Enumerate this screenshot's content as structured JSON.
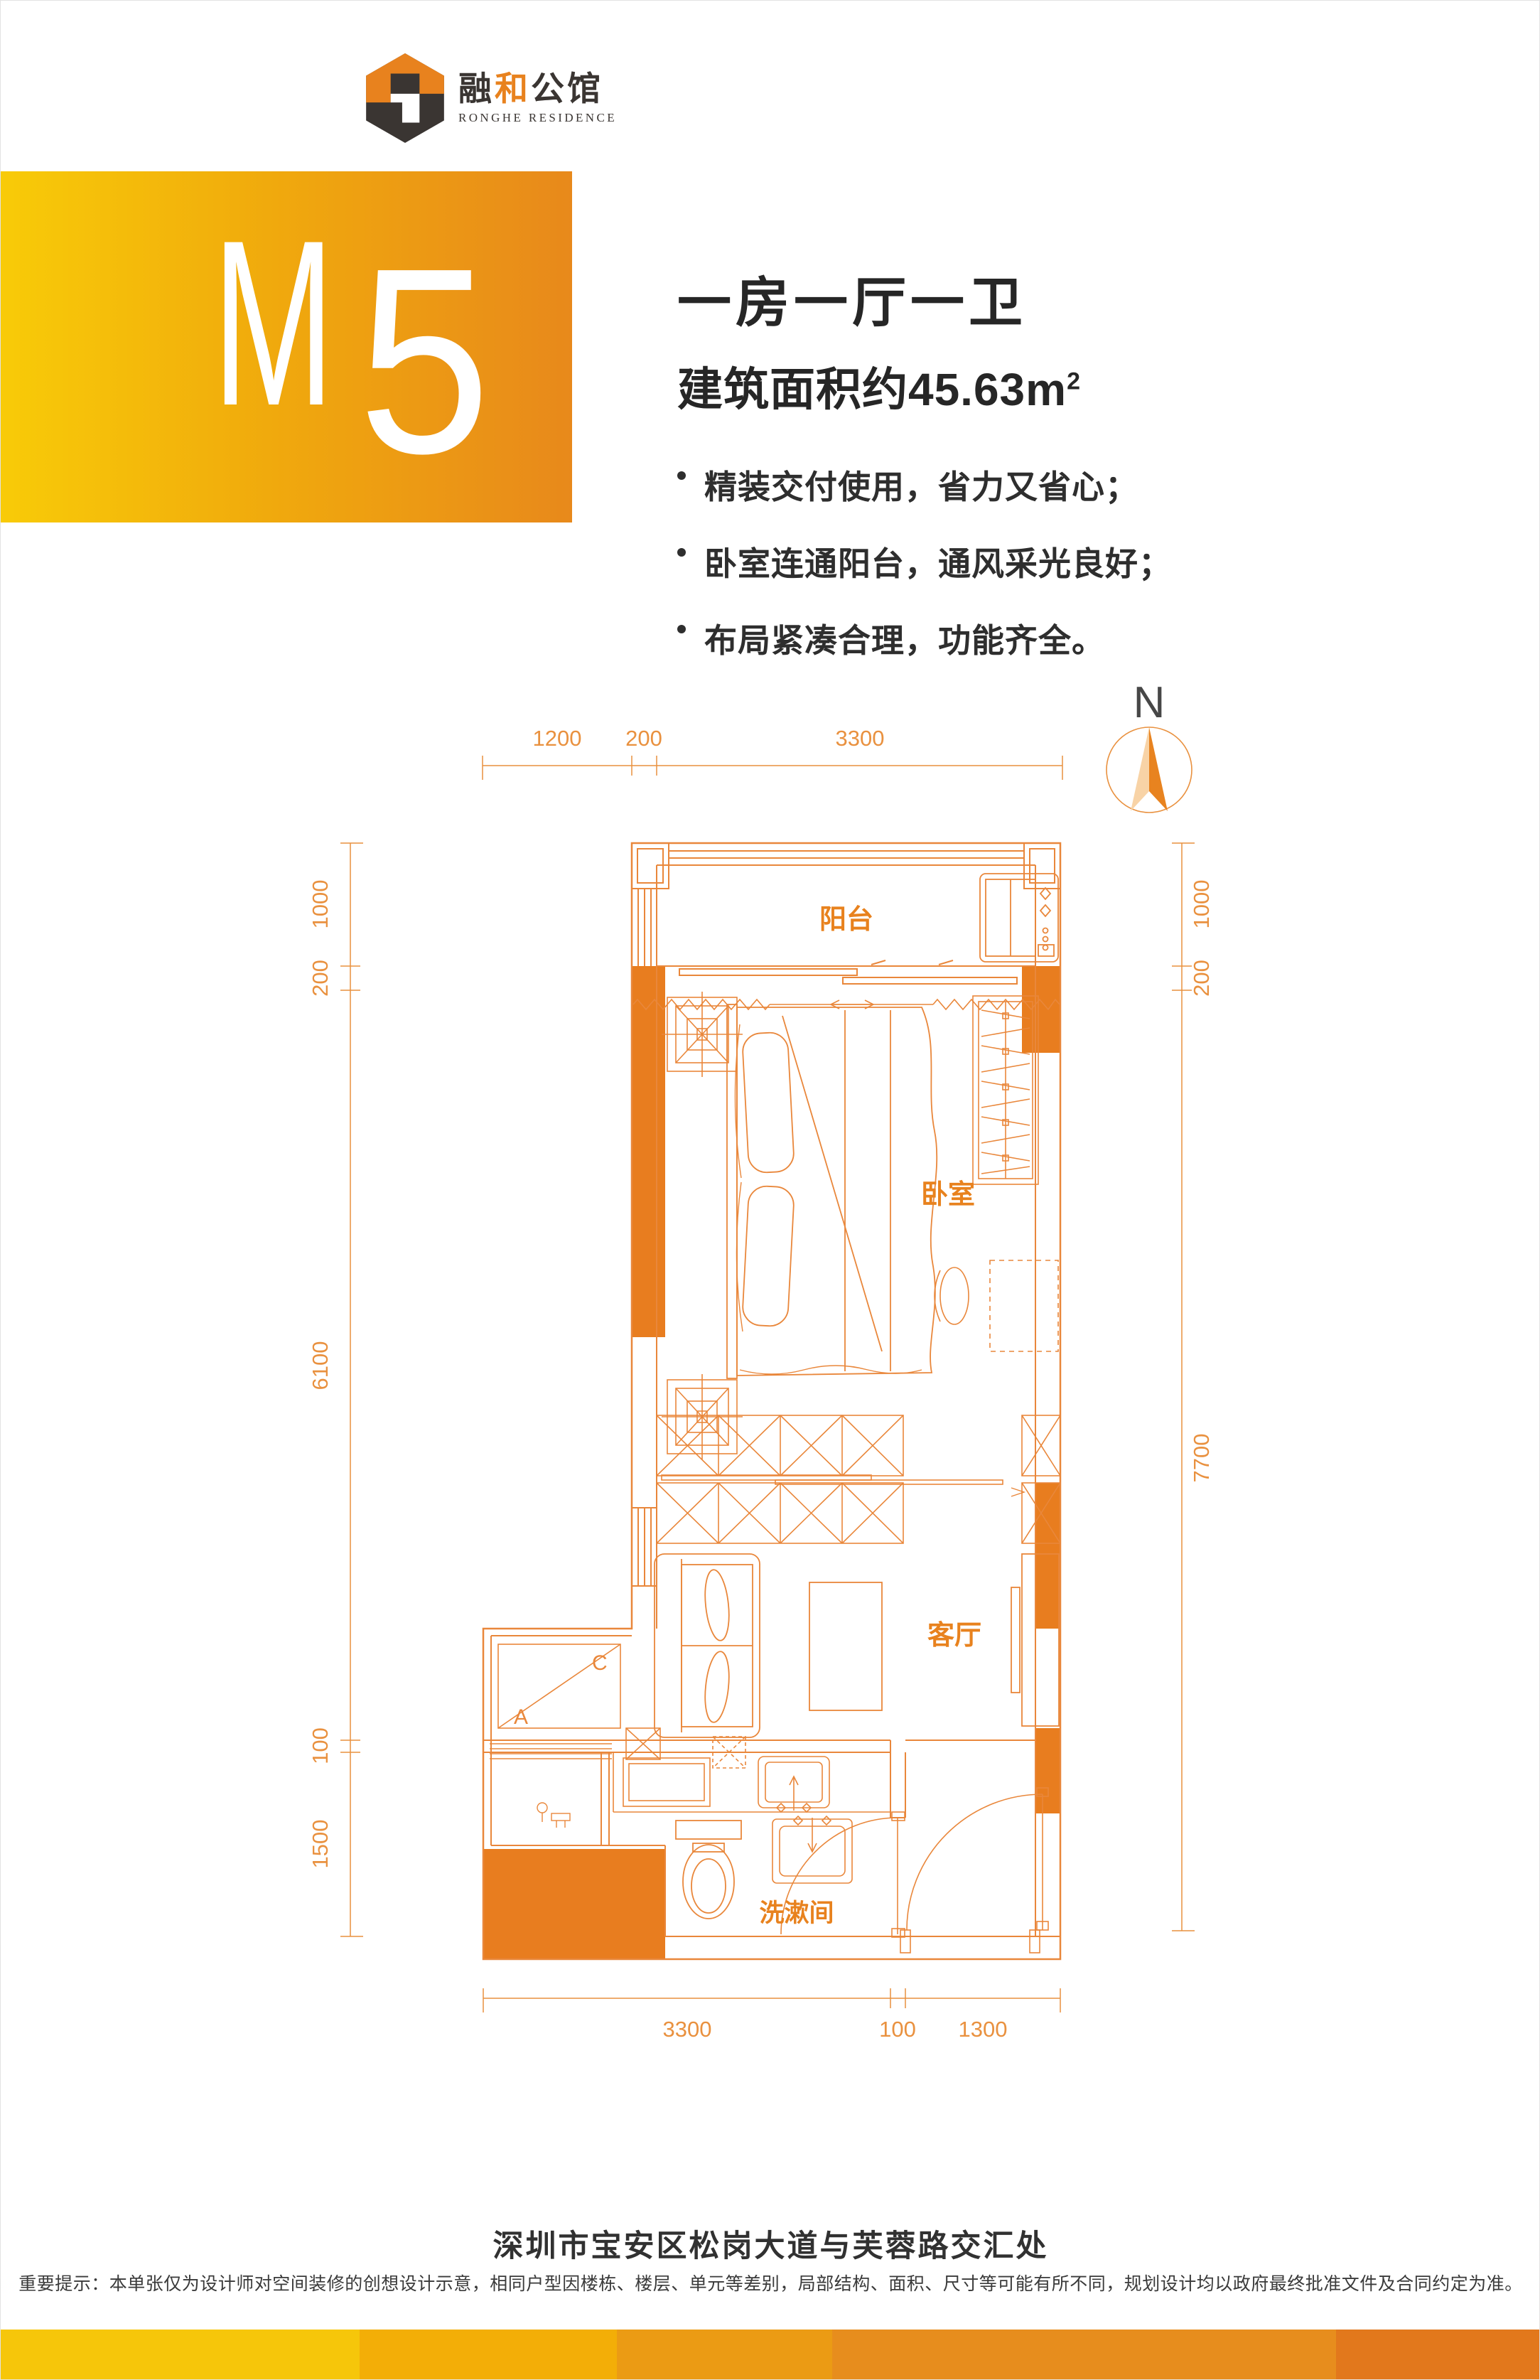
{
  "brand": {
    "name_dark1": "融",
    "name_accent": "和",
    "name_dark2": "公馆",
    "name_en": "RONGHE RESIDENCE"
  },
  "banner": {
    "unit_letter": "M",
    "unit_digit": "5"
  },
  "summary": {
    "title": "一房一厅一卫",
    "area_text": "建筑面积约45.63m",
    "area_sup": "2",
    "features": [
      "精装交付使用，省力又省心；",
      "卧室连通阳台，通风采光良好；",
      "布局紧凑合理，功能齐全。"
    ]
  },
  "plan": {
    "north_label": "N",
    "rooms": {
      "balcony": "阳台",
      "bedroom": "卧室",
      "living": "客厅",
      "washroom": "洗漱间"
    },
    "ac": {
      "a": "A",
      "c": "C"
    },
    "dims": {
      "top": [
        "1200",
        "200",
        "3300"
      ],
      "left": [
        "1000",
        "200",
        "6100",
        "100",
        "1500"
      ],
      "right": [
        "1000",
        "200",
        "7700"
      ],
      "bottom": [
        "3300",
        "100",
        "1300"
      ]
    }
  },
  "footer": {
    "address": "深圳市宝安区松岗大道与芙蓉路交汇处",
    "disclaimer": "重要提示：本单张仅为设计师对空间装修的创想设计示意，相同户型因楼栋、楼层、单元等差别，局部结构、面积、尺寸等可能有所不同，规划设计均以政府最终批准文件及合同约定为准。"
  },
  "colors": {
    "accent": "#e8821e",
    "plan_line": "#e9873b",
    "plan_fill": "#e87d1f",
    "dim_text": "#e9913f",
    "banner_from": "#f8cb08",
    "banner_to": "#e8891b"
  }
}
